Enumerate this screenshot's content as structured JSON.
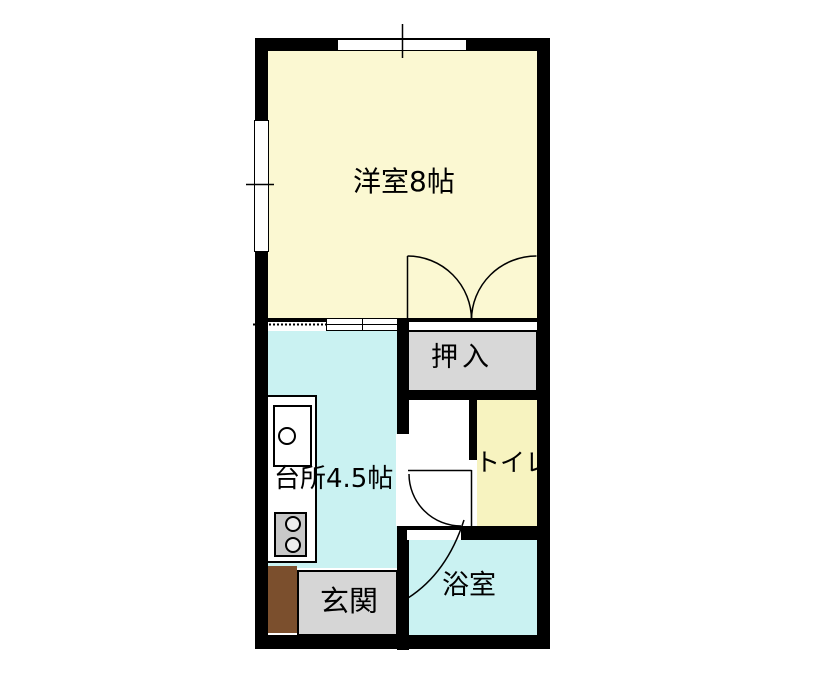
{
  "floorplan": {
    "type": "japanese-apartment-floor-plan",
    "rooms": {
      "western_room": {
        "label": "洋室8帖",
        "color": "#fbf8d2"
      },
      "closet": {
        "label": "押入",
        "color": "#d8d8d8"
      },
      "kitchen": {
        "label": "台所4.5帖",
        "color": "#caf2f2"
      },
      "toilet": {
        "label": "トイレ",
        "color": "#f7f3c0"
      },
      "bathroom": {
        "label": "浴室",
        "color": "#caf2f2"
      },
      "entrance": {
        "label": "玄関",
        "color": "#d6d6d6"
      }
    },
    "colors": {
      "wall": "#000000",
      "background": "#ffffff",
      "entrance_step": "#7b4f2d",
      "stove": "#c8c8c8"
    }
  }
}
